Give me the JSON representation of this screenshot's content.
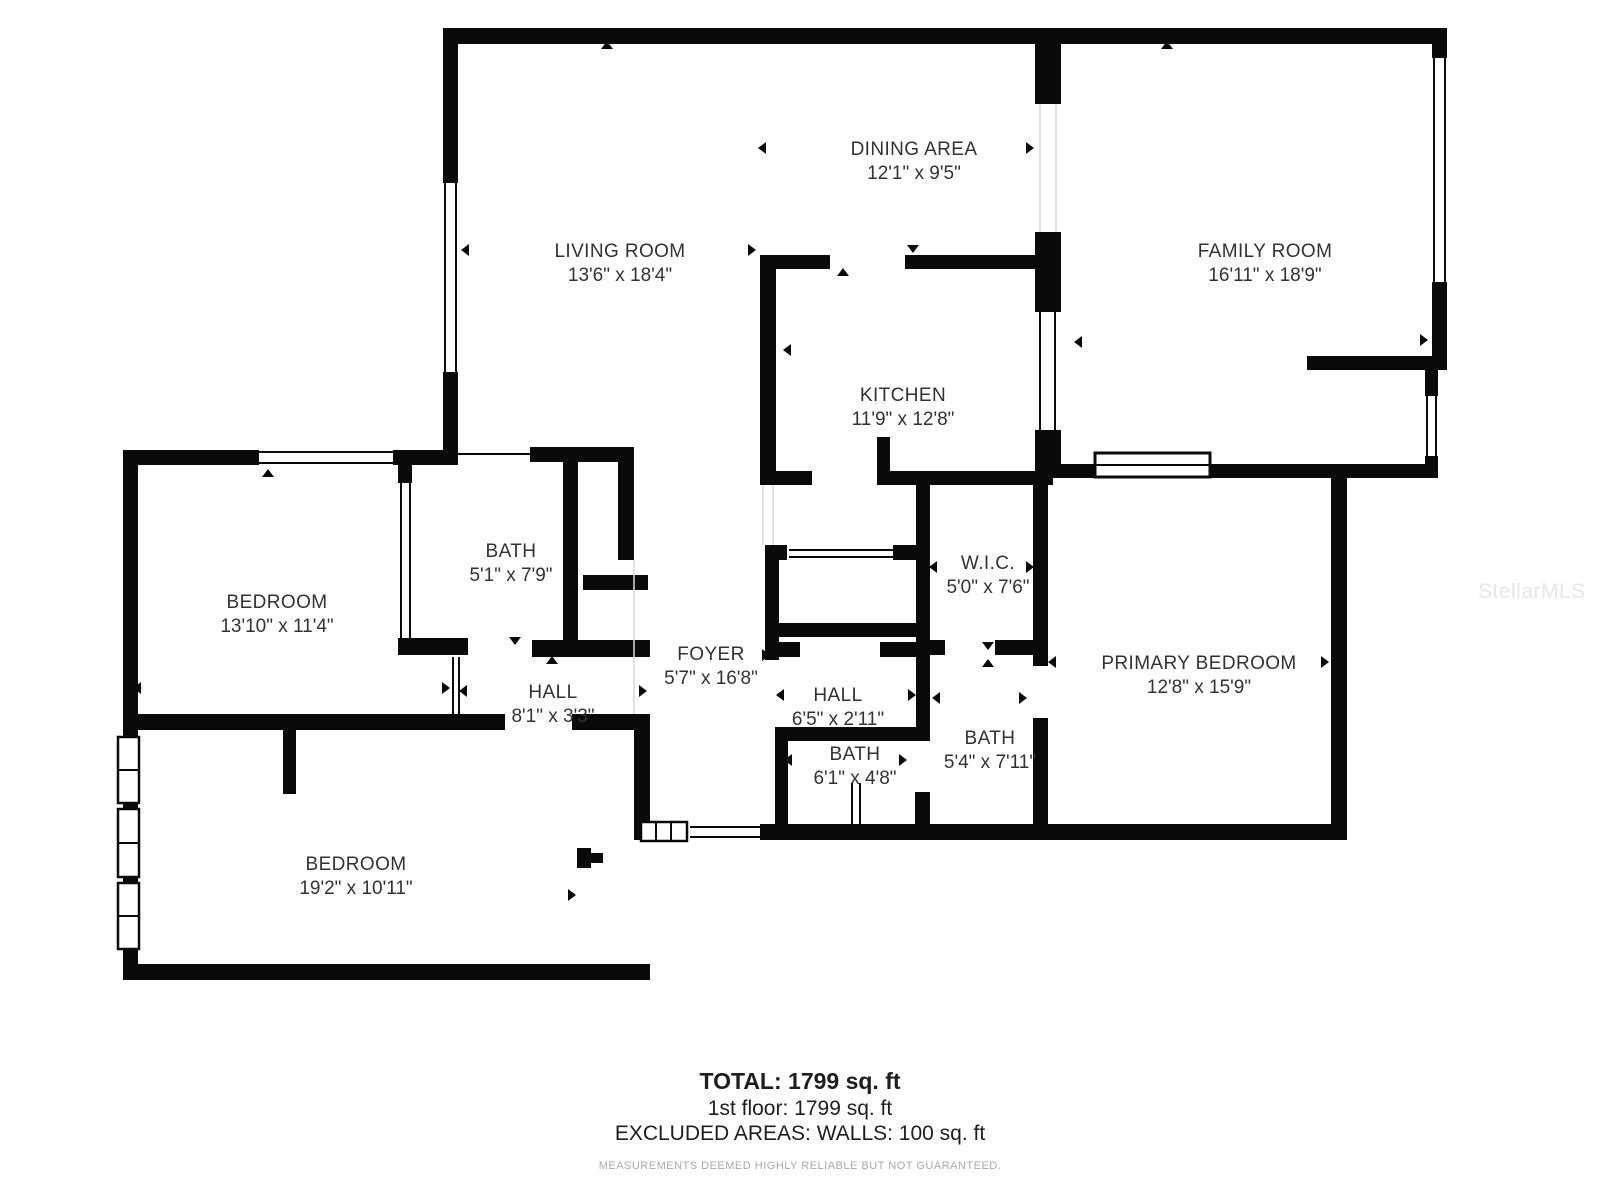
{
  "watermark": "StellarMLS",
  "rooms": [
    {
      "name": "DINING AREA",
      "dims": "12'1\" x 9'5\""
    },
    {
      "name": "LIVING ROOM",
      "dims": "13'6\" x 18'4\""
    },
    {
      "name": "FAMILY ROOM",
      "dims": "16'11\" x 18'9\""
    },
    {
      "name": "KITCHEN",
      "dims": "11'9\" x 12'8\""
    },
    {
      "name": "BATH",
      "dims": "5'1\" x 7'9\""
    },
    {
      "name": "BEDROOM",
      "dims": "13'10\" x 11'4\""
    },
    {
      "name": "W.I.C.",
      "dims": "5'0\" x 7'6\""
    },
    {
      "name": "FOYER",
      "dims": "5'7\" x 16'8\""
    },
    {
      "name": "HALL",
      "dims": "8'1\" x 3'3\""
    },
    {
      "name": "HALL",
      "dims": "6'5\" x 2'11\""
    },
    {
      "name": "PRIMARY BEDROOM",
      "dims": "12'8\" x 15'9\""
    },
    {
      "name": "BATH",
      "dims": "6'1\" x 4'8\""
    },
    {
      "name": "BATH",
      "dims": "5'4\" x 7'11\""
    },
    {
      "name": "BEDROOM",
      "dims": "19'2\" x 10'11\""
    }
  ],
  "summary": {
    "total": "TOTAL: 1799 sq. ft",
    "first_floor": "1st floor: 1799 sq. ft",
    "excluded": "EXCLUDED AREAS: WALLS: 100 sq. ft",
    "disclaimer": "MEASUREMENTS DEEMED HIGHLY RELIABLE BUT NOT GUARANTEED."
  },
  "colors": {
    "wall": "#0a0a0a",
    "text": "#323232",
    "muted": "#a9a9a9",
    "watermark": "#e7e7e7"
  }
}
